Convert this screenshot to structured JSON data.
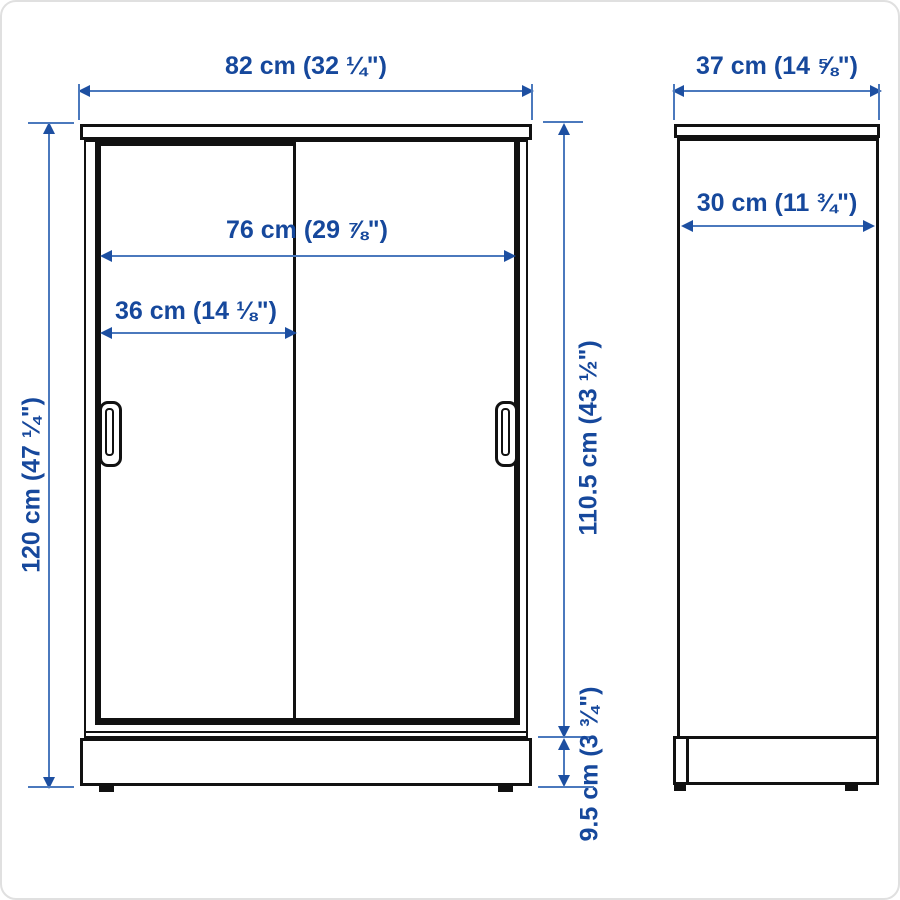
{
  "page": {
    "background": "#ffffff",
    "frame_color": "#e0e0e0"
  },
  "colors": {
    "line_black": "#111111",
    "dim_text": "#16489c",
    "dim_line": "#4b79bd",
    "dim_arrow": "#1d4fa1"
  },
  "views": {
    "front": "front-elevation-of-sliding-door-cabinet",
    "side": "side-elevation-of-cabinet"
  },
  "dimensions": {
    "front_width": {
      "label": "82 cm (32 ¼\")"
    },
    "side_depth": {
      "label": "37 cm (14 ⅝\")"
    },
    "opening_width": {
      "label": "76 cm (29 ⅞\")"
    },
    "door_width": {
      "label": "36 cm (14 ⅛\")"
    },
    "inner_depth": {
      "label": "30 cm (11 ¾\")"
    },
    "total_height": {
      "label": "120 cm (47 ¼\")"
    },
    "door_height": {
      "label": "110.5 cm (43 ½\")"
    },
    "plinth_height": {
      "label": "9.5 cm (3 ¾\")"
    }
  }
}
